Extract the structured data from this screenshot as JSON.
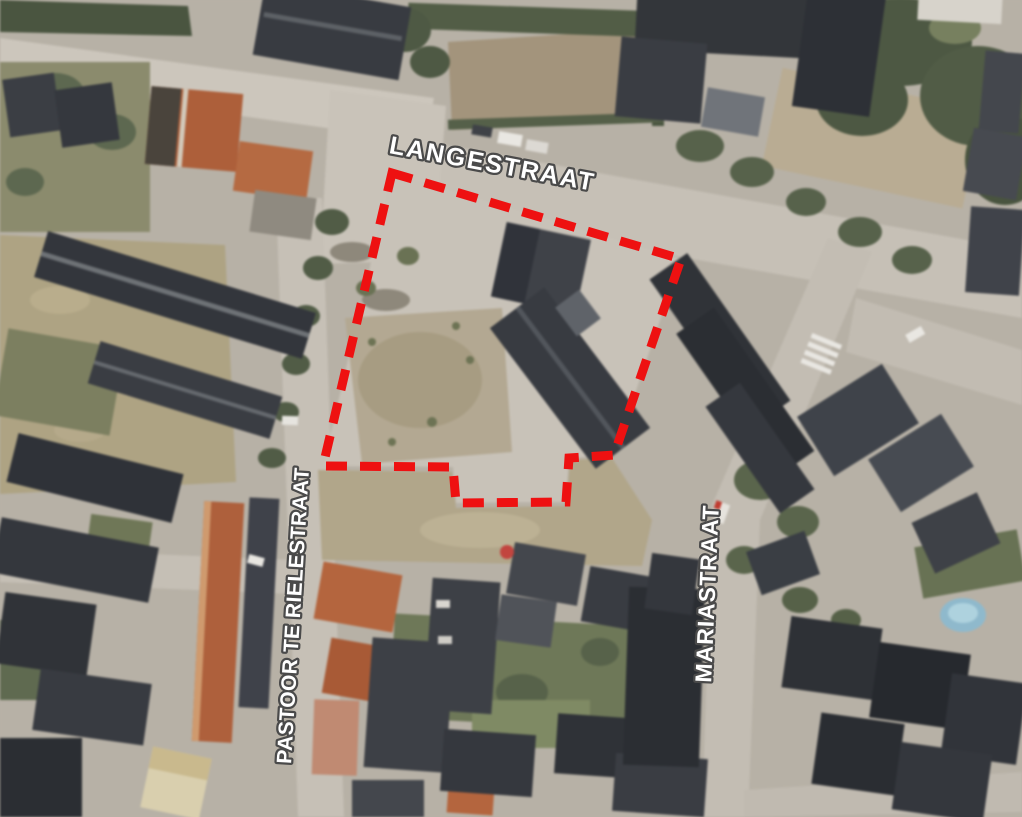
{
  "page": {
    "width": 1022,
    "height": 817,
    "type": "aerial-photograph-with-parcel-overlay",
    "description": "Satellite view of a village block with a red dashed boundary marking a development parcel"
  },
  "street_labels": [
    {
      "id": "langestraat",
      "text": "LANGESTRAAT"
    },
    {
      "id": "pastoor-te-rielestraat",
      "text": "PASTOOR TE RIELESTRAAT"
    },
    {
      "id": "mariastraat",
      "text": "MARIASTRAAT"
    }
  ],
  "label_style": {
    "fill": "#ffffff",
    "outline": "#4a4a4a"
  },
  "parcel_outline": {
    "points": "392,173 681,259 614,455 569,458 566,502 456,503 453,467 323,466",
    "stroke_color": "#ee1111",
    "stroke_width": 9,
    "dash": "21 13",
    "style": "dashed"
  },
  "scene_colors": {
    "paved_road": "#c6c0b6",
    "parcel_ground": "#c8c2b8",
    "dry_field": "#aea383",
    "brown_field": "#a3947c",
    "dark_roof": "#33363c",
    "orange_roof": "#b0613c",
    "vegetation": "#5a654c",
    "pool_blue": "#8fb9cc"
  }
}
